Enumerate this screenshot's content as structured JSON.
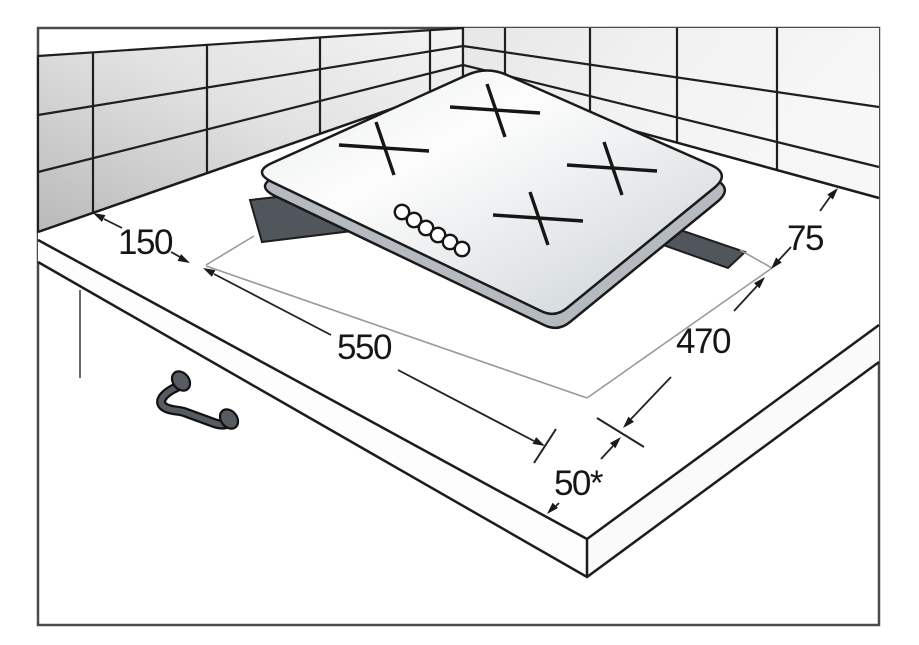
{
  "diagram": {
    "kind": "hob-installation-cutout-diagram",
    "dimensions": {
      "wall_clearance_left": {
        "label": "150"
      },
      "cutout_width": {
        "label": "550"
      },
      "cutout_depth": {
        "label": "470"
      },
      "wall_clearance_back": {
        "label": "75"
      },
      "front_edge_clearance": {
        "label": "50*"
      }
    },
    "cooktop": {
      "burner_count": 4,
      "control_knob_count": 6
    },
    "colors": {
      "line": "#1a1a1a",
      "frame": "#4a4a4a",
      "cutout_fill": "#50565b",
      "cooktop_side": "#b4bac0",
      "tile_light": "#f5f5f5",
      "tile_shaded": "#bdbdbd",
      "background": "#ffffff"
    }
  }
}
